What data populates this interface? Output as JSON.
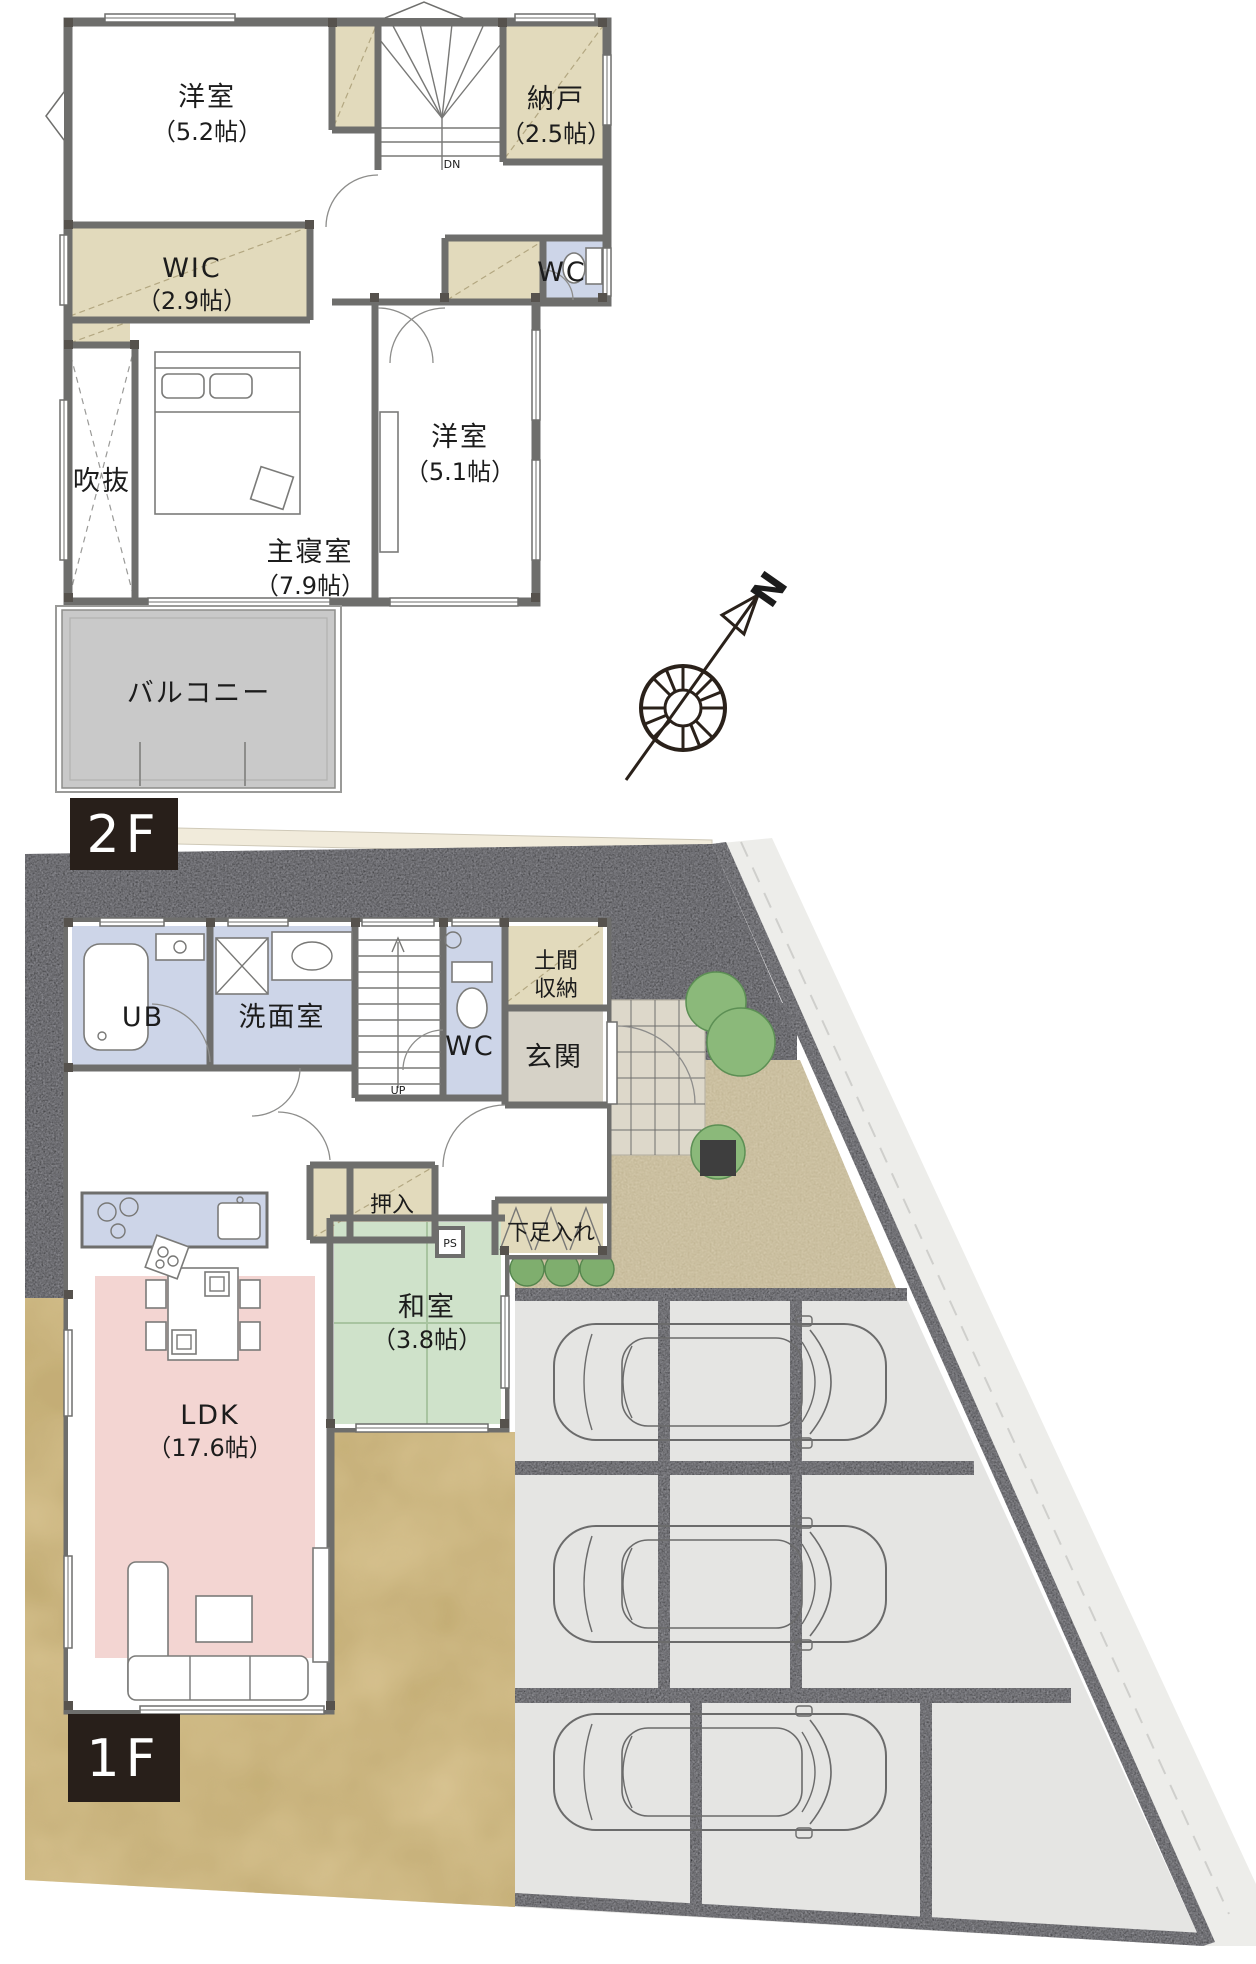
{
  "document": {
    "type": "floorplan",
    "floors": [
      "2F",
      "1F"
    ]
  },
  "f2": {
    "tag": "2F",
    "rooms": {
      "y52": {
        "name": "洋室",
        "size": "（5.2帖）"
      },
      "nando": {
        "name": "納戸",
        "size": "（2.5帖）"
      },
      "wic": {
        "name": "WIC",
        "size": "（2.9帖）"
      },
      "wc": {
        "name": "WC"
      },
      "fukinuke": {
        "name": "吹抜"
      },
      "master": {
        "name": "主寝室",
        "size": "（7.9帖）"
      },
      "y51": {
        "name": "洋室",
        "size": "（5.1帖）"
      },
      "balcony": {
        "name": "バルコニー"
      },
      "stairs": {
        "name": "DN"
      }
    }
  },
  "f1": {
    "tag": "1F",
    "rooms": {
      "ub": {
        "name": "UB"
      },
      "senmen": {
        "name": "洗面室"
      },
      "wc": {
        "name": "WC"
      },
      "genkan": {
        "name": "玄関"
      },
      "doma_l1": {
        "name": "土間"
      },
      "doma_l2": {
        "name": "収納"
      },
      "oshiire": {
        "name": "押入"
      },
      "ps": {
        "name": "PS"
      },
      "getabako": {
        "name": "下足入れ"
      },
      "washitsu": {
        "name": "和室",
        "size": "（3.8帖）"
      },
      "ldk": {
        "name": "LDK",
        "size": "（17.6帖）"
      },
      "stairs": {
        "name": "UP"
      }
    }
  },
  "compass": {
    "north": "N"
  },
  "site": {
    "parking_spaces": 3,
    "cars": 3
  },
  "colors": {
    "tag_bg": "#281f1a",
    "closet_tan": "#e2dabc",
    "wet_blue": "#cdd5e8",
    "tatami_green": "#cfe2ca",
    "ldk_pink": "#f3d5d2",
    "balcony_gray": "#c9c9c9",
    "genkan_floor": "#d6d2c7",
    "wall_gray": "#6e6e6c",
    "site_wall": "#97979d",
    "gravel": "#d8cdb0",
    "yard_tan": "#d9c493",
    "parking": "#e5e5e3",
    "tree_green": "#8bb97a"
  }
}
